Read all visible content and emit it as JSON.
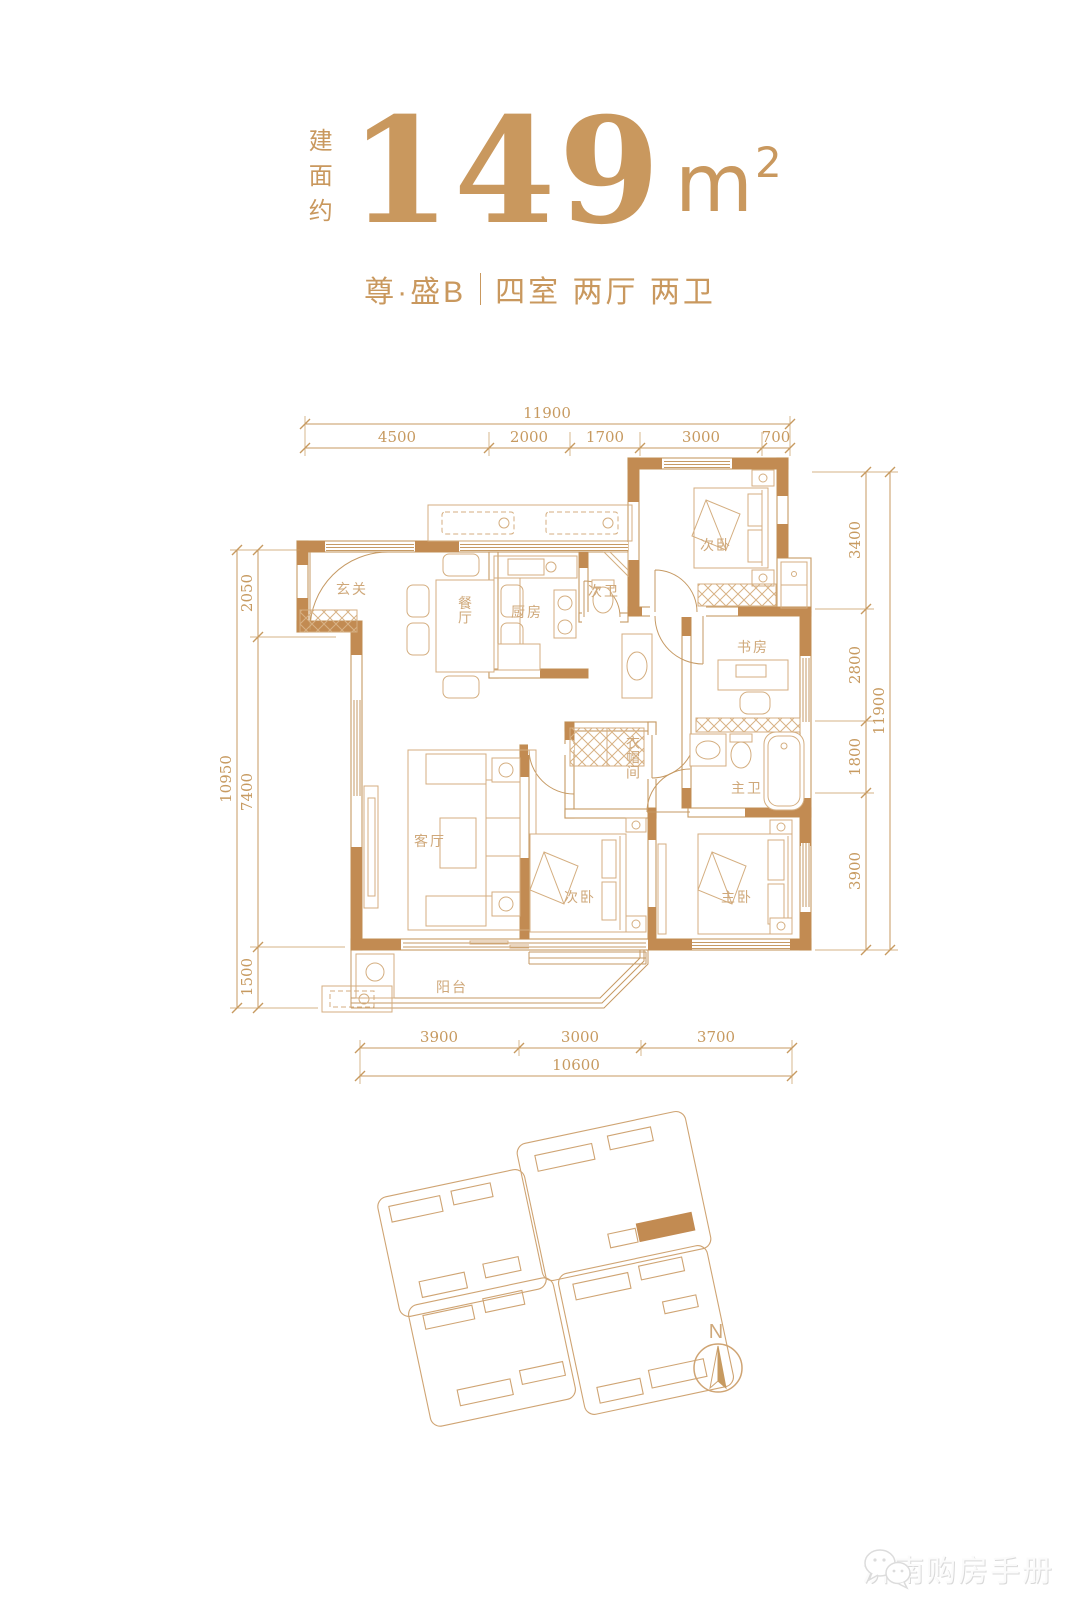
{
  "header": {
    "area_label": "建面约",
    "area_value": "149",
    "area_unit": "m",
    "area_sup": "2",
    "project_name": "尊·盛B",
    "layout": "四室 两厅 两卫"
  },
  "plan": {
    "rooms": {
      "entrance": "玄关",
      "dining": "餐厅",
      "kitchen": "厨房",
      "guest_bath": "次卫",
      "bedroom_top": "次卧",
      "study": "书房",
      "cloakroom": "衣帽间",
      "master_bath": "主卫",
      "living": "客厅",
      "bedroom_mid": "次卧",
      "master_bedroom": "主卧",
      "balcony": "阳台"
    },
    "dimensions": {
      "top": {
        "total": "11900",
        "segments": [
          "4500",
          "2000",
          "1700",
          "3000",
          "700"
        ]
      },
      "bottom": {
        "total": "10600",
        "segments": [
          "3900",
          "3000",
          "3700"
        ]
      },
      "left": {
        "total": "10950",
        "segments": [
          "2050",
          "7400",
          "1500"
        ]
      },
      "right": {
        "total": "11900",
        "segments": [
          "3400",
          "2800",
          "1800",
          "3900"
        ]
      }
    }
  },
  "compass": {
    "label": "N"
  },
  "watermark": {
    "text": "济南购房手册"
  },
  "colors": {
    "gold": "#c9985e",
    "wall_fill": "#c28b52",
    "line": "#c79a60",
    "furniture_line": "#d4ae80"
  }
}
